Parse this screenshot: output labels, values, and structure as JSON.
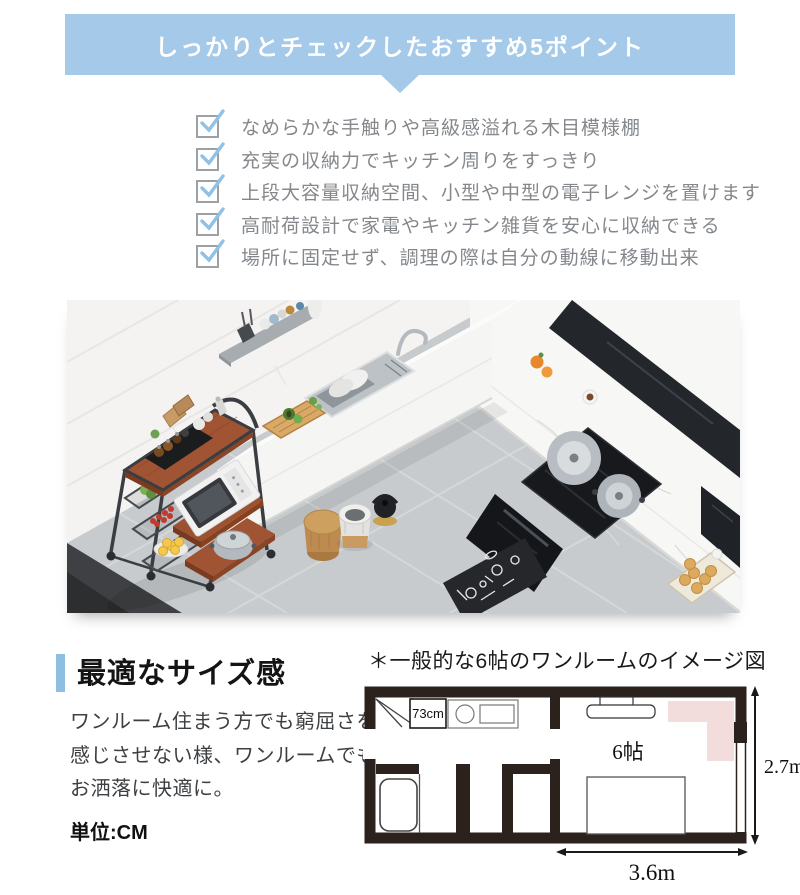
{
  "colors": {
    "banner_blue": "#a5c9e8",
    "check_blue": "#8fc2e6",
    "accent_bar_blue": "#8fbfe0",
    "checklist_text_gray": "#84888c",
    "plan_wall": "#2b211d",
    "plan_pink": "#f2dcdc",
    "rack_wood": "#9c5230"
  },
  "banner": {
    "title": "しっかりとチェックしたおすすめ5ポイント"
  },
  "checklist": {
    "items": [
      {
        "label": "なめらかな手触りや高級感溢れる木目模様棚"
      },
      {
        "label": "充実の収納力でキッチン周りをすっきり"
      },
      {
        "label": "上段大容量収納空間、小型や中型の電子レンジを置けます"
      },
      {
        "label": "高耐荷設計で家電やキッチン雑貨を安心に収納できる"
      },
      {
        "label": "場所に固定せず、調理の際は自分の動線に移動出来"
      }
    ]
  },
  "size_section": {
    "heading": "最適なサイズ感",
    "body_lines": [
      "ワンルーム住まう方でも窮屈さを",
      "感じさせない様、ワンルームでも",
      "お洒落に快適に。"
    ],
    "unit_label": "単位:CM",
    "caption": "＊一般的な6帖のワンルームのイメージ図"
  },
  "floor_plan": {
    "rack_width_label": "73cm",
    "room_label": "6帖",
    "height_label": "2.7m",
    "width_label": "3.6m"
  }
}
